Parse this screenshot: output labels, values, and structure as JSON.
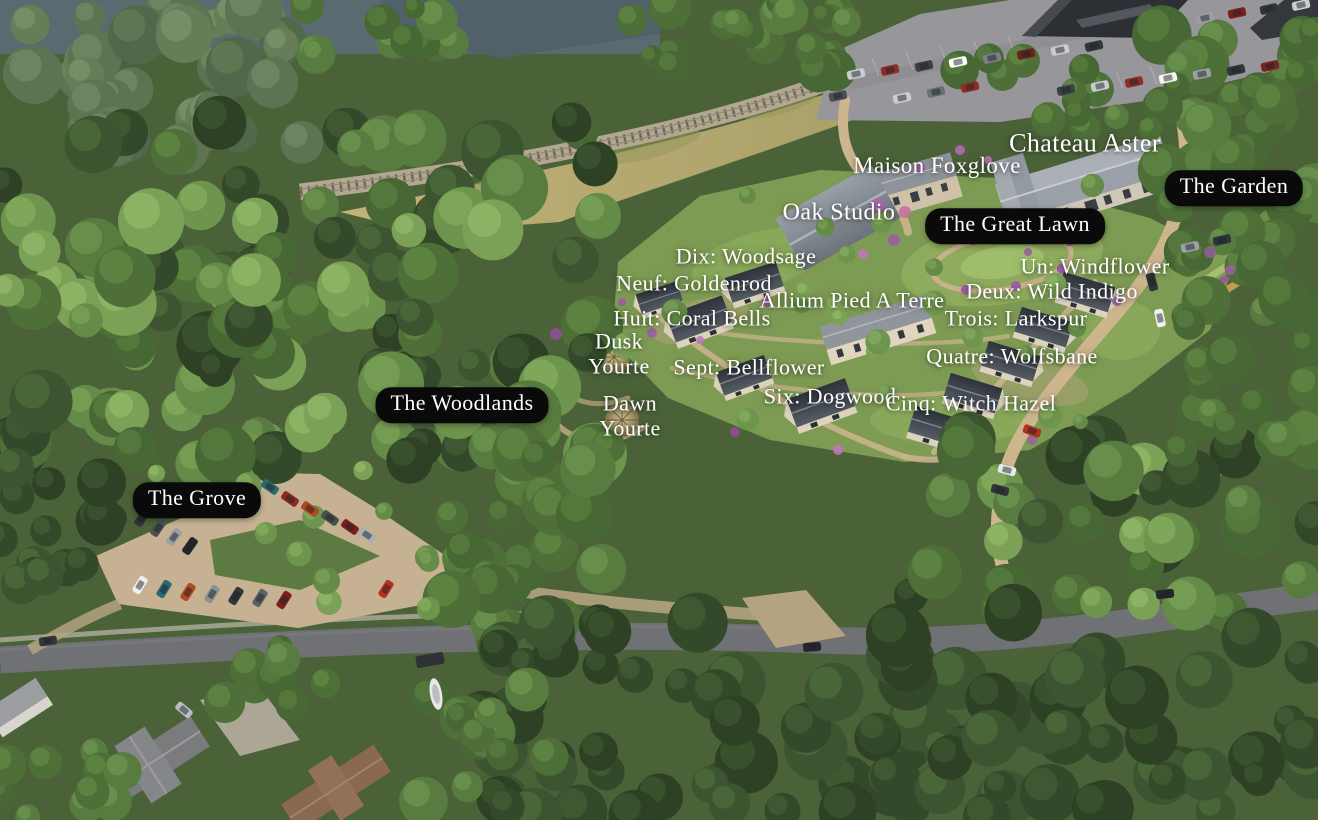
{
  "aerial_map": {
    "style": {
      "pill_background": "#0a0a0a",
      "label_color": "#ffffff"
    },
    "area_pills": [
      {
        "id": "the-garden",
        "text": "The Garden"
      },
      {
        "id": "the-great-lawn",
        "text": "The Great Lawn"
      },
      {
        "id": "the-woodlands",
        "text": "The Woodlands"
      },
      {
        "id": "the-grove",
        "text": "The Grove"
      }
    ],
    "place_labels": [
      {
        "id": "chateau-aster",
        "text": "Chateau Aster"
      },
      {
        "id": "maison-foxglove",
        "text": "Maison Foxglove"
      },
      {
        "id": "oak-studio",
        "text": "Oak Studio"
      },
      {
        "id": "dix-woodsage",
        "text": "Dix: Woodsage"
      },
      {
        "id": "neuf-goldenrod",
        "text": "Neuf: Goldenrod"
      },
      {
        "id": "allium-pied-a-terre",
        "text": "Allium Pied A Terre"
      },
      {
        "id": "un-windflower",
        "text": "Un: Windflower"
      },
      {
        "id": "deux-wild-indigo",
        "text": "Deux: Wild Indigo"
      },
      {
        "id": "huit-coral-bells",
        "text": "Huit: Coral Bells"
      },
      {
        "id": "trois-larkspur",
        "text": "Trois: Larkspur"
      },
      {
        "id": "sept-bellflower",
        "text": "Sept: Bellflower"
      },
      {
        "id": "quatre-wolfsbane",
        "text": "Quatre: Wolfsbane"
      },
      {
        "id": "six-dogwood",
        "text": "Six: Dogwood"
      },
      {
        "id": "cinq-witch-hazel",
        "text": "Cinq: Witch Hazel"
      }
    ],
    "yurt_labels": [
      {
        "id": "dusk-yourte",
        "line1": "Dusk",
        "line2": "Yourte"
      },
      {
        "id": "dawn-yourte",
        "line1": "Dawn",
        "line2": "Yourte"
      }
    ]
  }
}
